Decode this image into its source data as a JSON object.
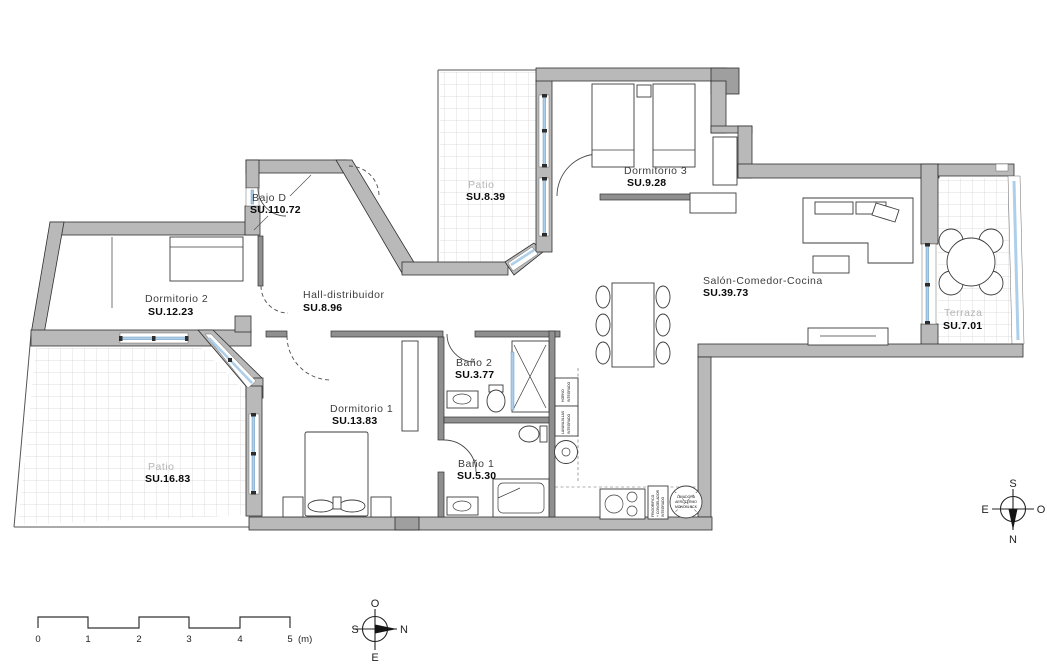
{
  "document": {
    "type": "apartment-floor-plan"
  },
  "rooms": [
    {
      "name": "Bajo D",
      "area": "SU.110.72"
    },
    {
      "name": "Dormitorio 2",
      "area": "SU.12.23"
    },
    {
      "name": "Hall-distribuidor",
      "area": "SU.8.96"
    },
    {
      "name": "Patio",
      "area": "SU.8.39"
    },
    {
      "name": "Dormitorio 3",
      "area": "SU.9.28"
    },
    {
      "name": "Salón-Comedor-Cocina",
      "area": "SU.39.73"
    },
    {
      "name": "Terraza",
      "area": "SU.7.01"
    },
    {
      "name": "Baño 2",
      "area": "SU.3.77"
    },
    {
      "name": "Dormitorio 1",
      "area": "SU.13.83"
    },
    {
      "name": "Baño 1",
      "area": "SU.5.30"
    },
    {
      "name": "Patio",
      "area": "SU.16.83"
    }
  ],
  "appliances": {
    "horno_l1": "HORNO",
    "horno_l2": "INTEGRADO",
    "lava_l1": "LAVAVAJILLAS",
    "lava_l2": "INTEGRADO",
    "frigo_l1": "FRIGORIFICO",
    "frigo_l2": "+ CONGELADOR",
    "frigo_l3": "INTEGRADO",
    "heater_l1": "LAVADORA",
    "heater_l2": "AEROTERMO",
    "heater_l3": "MONOBLOCK"
  },
  "scale_bar": {
    "t0": "0",
    "t1": "1",
    "t2": "2",
    "t3": "3",
    "t4": "4",
    "t5": "5",
    "unit": "(m)"
  },
  "compass_plan": {
    "top": "O",
    "left": "S",
    "right": "N",
    "bottom": "E"
  },
  "compass_site": {
    "top": "S",
    "left": "E",
    "right": "O",
    "bottom": "N"
  },
  "colors": {
    "wall": "#b9b9b9",
    "window": "#aecfea",
    "tile_grid": "#d2d2d2",
    "area_text": "#0a0a0a",
    "exterior_text": "#b5b5b5"
  }
}
